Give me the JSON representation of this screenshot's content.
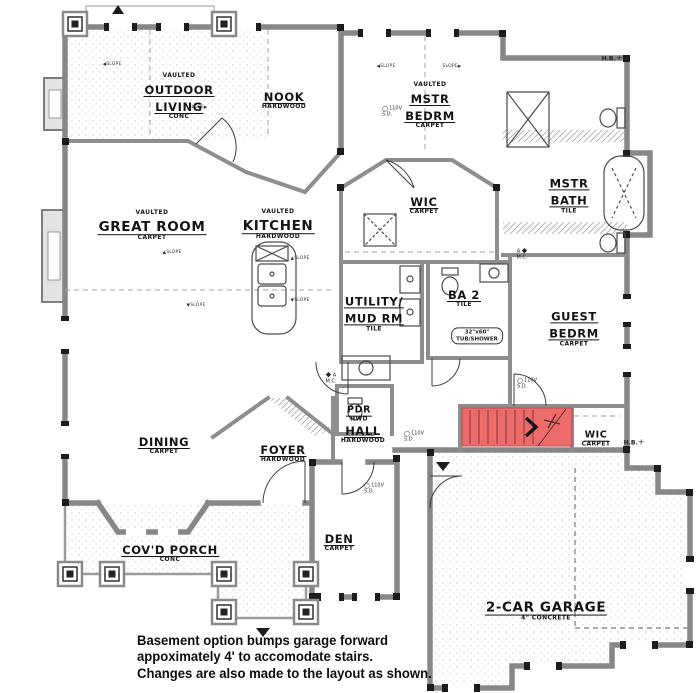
{
  "rooms": {
    "outdoor_living": {
      "prefix": "VAULTED",
      "line1": "OUTDOOR",
      "line2": "LIVING",
      "floor": "CONC"
    },
    "nook": {
      "name": "NOOK",
      "floor": "HARDWOOD"
    },
    "mstr_bedrm": {
      "prefix": "VAULTED",
      "line1": "MSTR",
      "line2": "BEDRM",
      "floor": "CARPET"
    },
    "mstr_bath": {
      "line1": "MSTR",
      "line2": "BATH",
      "floor": "TILE"
    },
    "great_room": {
      "prefix": "VAULTED",
      "name": "GREAT ROOM",
      "floor": "CARPET"
    },
    "kitchen": {
      "prefix": "VAULTED",
      "name": "KITCHEN",
      "floor": "HARDWOOD"
    },
    "wic_master": {
      "name": "WIC",
      "floor": "CARPET"
    },
    "utility": {
      "line1": "UTILITY/",
      "line2": "MUD RM",
      "floor": "TILE"
    },
    "ba2": {
      "name": "BA 2",
      "floor": "TILE"
    },
    "guest_bedrm": {
      "line1": "GUEST",
      "line2": "BEDRM",
      "floor": "CARPET"
    },
    "pdr": {
      "name": "PDR",
      "floor": "HWD"
    },
    "dining": {
      "name": "DINING",
      "floor": "CARPET"
    },
    "foyer": {
      "name": "FOYER",
      "floor": "HARDWOOD"
    },
    "hall": {
      "name": "HALL",
      "floor": "HARDWOOD"
    },
    "den": {
      "name": "DEN",
      "floor": "CARPET"
    },
    "covd_porch": {
      "name": "COV'D PORCH",
      "floor": "CONC"
    },
    "wic_hall": {
      "name": "WIC",
      "floor": "CARPET"
    },
    "garage": {
      "name": "2-CAR GARAGE",
      "floor": "4\" CONCRETE"
    }
  },
  "fixtures": {
    "tub_note_line1": "32\"x60\"",
    "tub_note_line2": "TUB/SHOWER"
  },
  "markers": {
    "hose_bib": "H.B.",
    "smoke_volts": "110V",
    "smoke_sd": "S.D.",
    "marker_a": "A",
    "medicine_cabinet": "M.C.",
    "slope": "SLOPE"
  },
  "caption": {
    "line1": "Basement option bumps garage forward",
    "line2": "appoximately 4' to accomodate stairs.",
    "line3": "Changes are also made to the layout as shown."
  },
  "colors": {
    "stairs_highlight": "#ee6b6b",
    "wall_gray": "#878787",
    "accent_black": "#1c1c1c",
    "paper": "#ffffff"
  }
}
